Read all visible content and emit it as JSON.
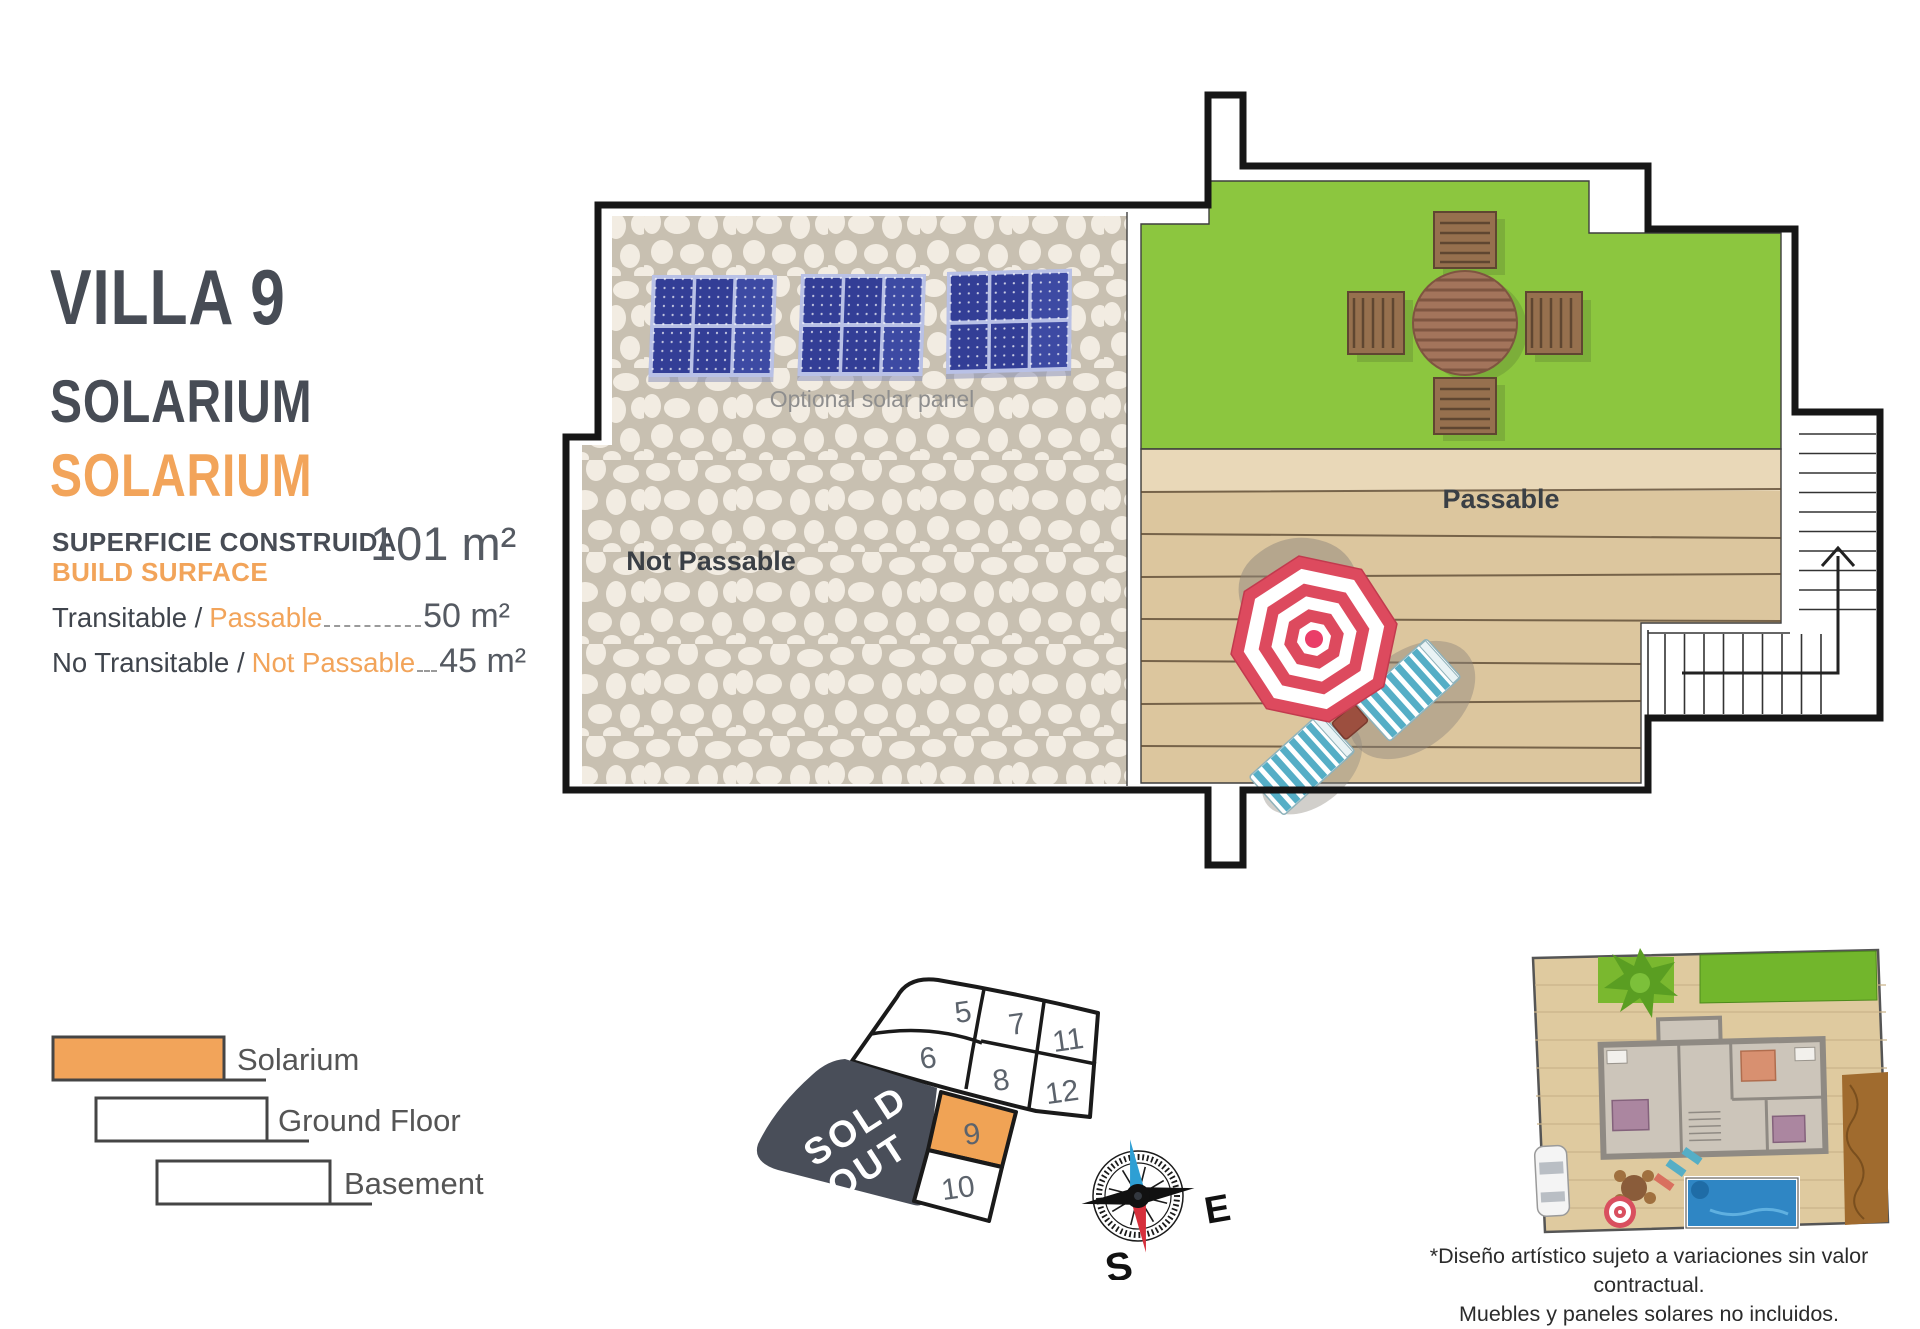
{
  "header": {
    "title": "VILLA 9",
    "subtitle_top": "SOLARIUM",
    "subtitle_bottom": "SOLARIUM"
  },
  "surface": {
    "label_line1": "SUPERFICIE CONSTRUIDA",
    "label_line2": "BUILD SURFACE",
    "total": "101 m²",
    "rows": [
      {
        "label": "Transitable /",
        "label_accent": "Passable",
        "value": "50 m²"
      },
      {
        "label": "No Transitable /",
        "label_accent": "Not Passable",
        "value": "45 m²"
      }
    ]
  },
  "plan": {
    "solar_label": "Optional solar panel",
    "not_passable": "Not Passable",
    "passable": "Passable"
  },
  "legend": {
    "items": [
      {
        "label": "Solarium"
      },
      {
        "label": "Ground Floor"
      },
      {
        "label": "Basement"
      }
    ]
  },
  "plot_map": {
    "sold_out": {
      "line1": "SOLD",
      "line2": "OUT"
    },
    "numbers": {
      "n5": "5",
      "n6": "6",
      "n7": "7",
      "n8": "8",
      "n11": "11",
      "n12": "12",
      "n9": "9",
      "n10": "10"
    },
    "highlighted_plot": "9"
  },
  "compass": {
    "east": "E",
    "south": "S"
  },
  "disclaimer": {
    "line1": "*Diseño artístico sujeto a variaciones sin valor contractual.",
    "line2": "Muebles y paneles solares no incluidos."
  },
  "colors": {
    "accent_orange": "#F2A45A",
    "dark_slate": "#474C55",
    "grass_green": "#8CC63F",
    "deck_tan": "#DCC69E",
    "panel_blue": "#333E96",
    "sold_out_gray": "#494E59",
    "umbrella_red": "#DD4A5E",
    "pool_blue": "#2F86C4"
  }
}
